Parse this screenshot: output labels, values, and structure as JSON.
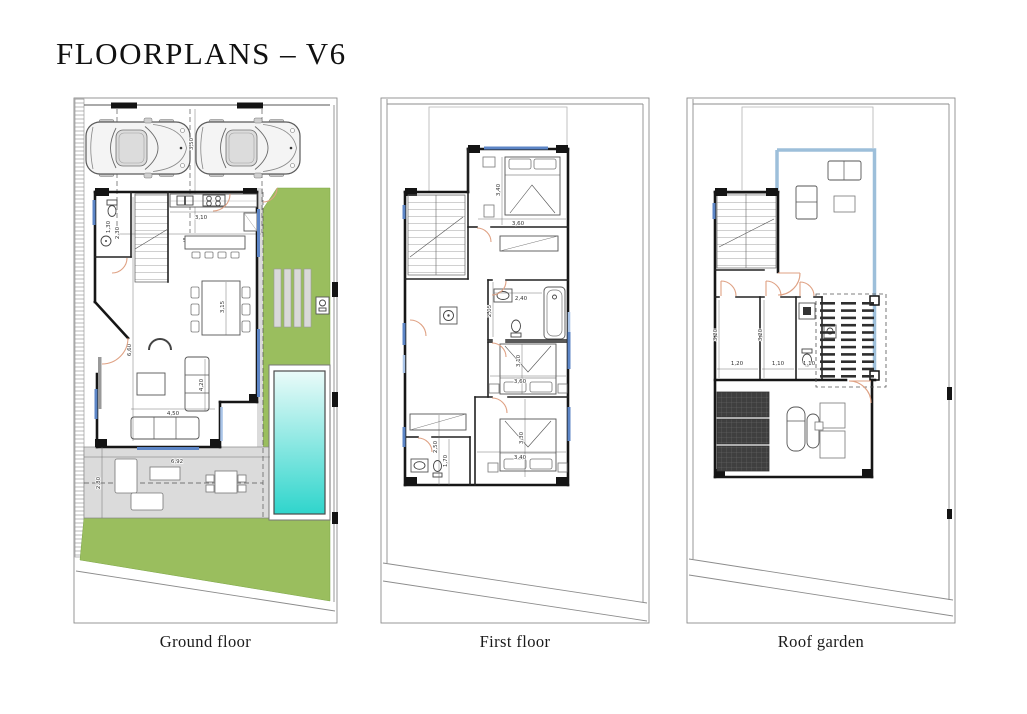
{
  "title": "FLOORPLANS – V6",
  "panels": {
    "ground_floor": {
      "caption": "Ground floor",
      "dims": {
        "parking_depth": "3,50",
        "parking_width": "5,60",
        "wc_width": "1,30",
        "wc_depth": "2,30",
        "kitchen_width": "3,10",
        "dining_depth": "3,15",
        "living_depth": "6,60",
        "sofa_depth": "4,20",
        "living_width": "4,50",
        "terrace_width": "6,92",
        "terrace_depth": "2,80"
      }
    },
    "first_floor": {
      "caption": "First floor",
      "dims": {
        "bedroom1_depth": "3,40",
        "bedroom1_width": "3,60",
        "bath1_depth": "2,05",
        "bath1_width": "2,40",
        "bedroom2_depth": "3,10",
        "bedroom2_width": "3,60",
        "bedroom3_depth": "3,30",
        "bedroom3_width": "3,40",
        "bath2_depth": "2,50",
        "bath2_width": "1,70"
      }
    },
    "roof_garden": {
      "caption": "Roof garden",
      "dims": {
        "store1_depth": "3,20",
        "store1_width": "1,20",
        "store2_depth": "3,20",
        "store2_width": "1,10",
        "wc_width": "1,10"
      }
    }
  },
  "colors": {
    "garden_green": "#9ABE5E",
    "pool_top": "#EAFBF9",
    "pool_bottom": "#2FD5CC",
    "terrace_gray": "#DBDBDB",
    "window_blue": "#5C85C6",
    "door_arc": "#DFA183",
    "balustrade_blue": "#9DBFDA",
    "wall": "#161616"
  }
}
